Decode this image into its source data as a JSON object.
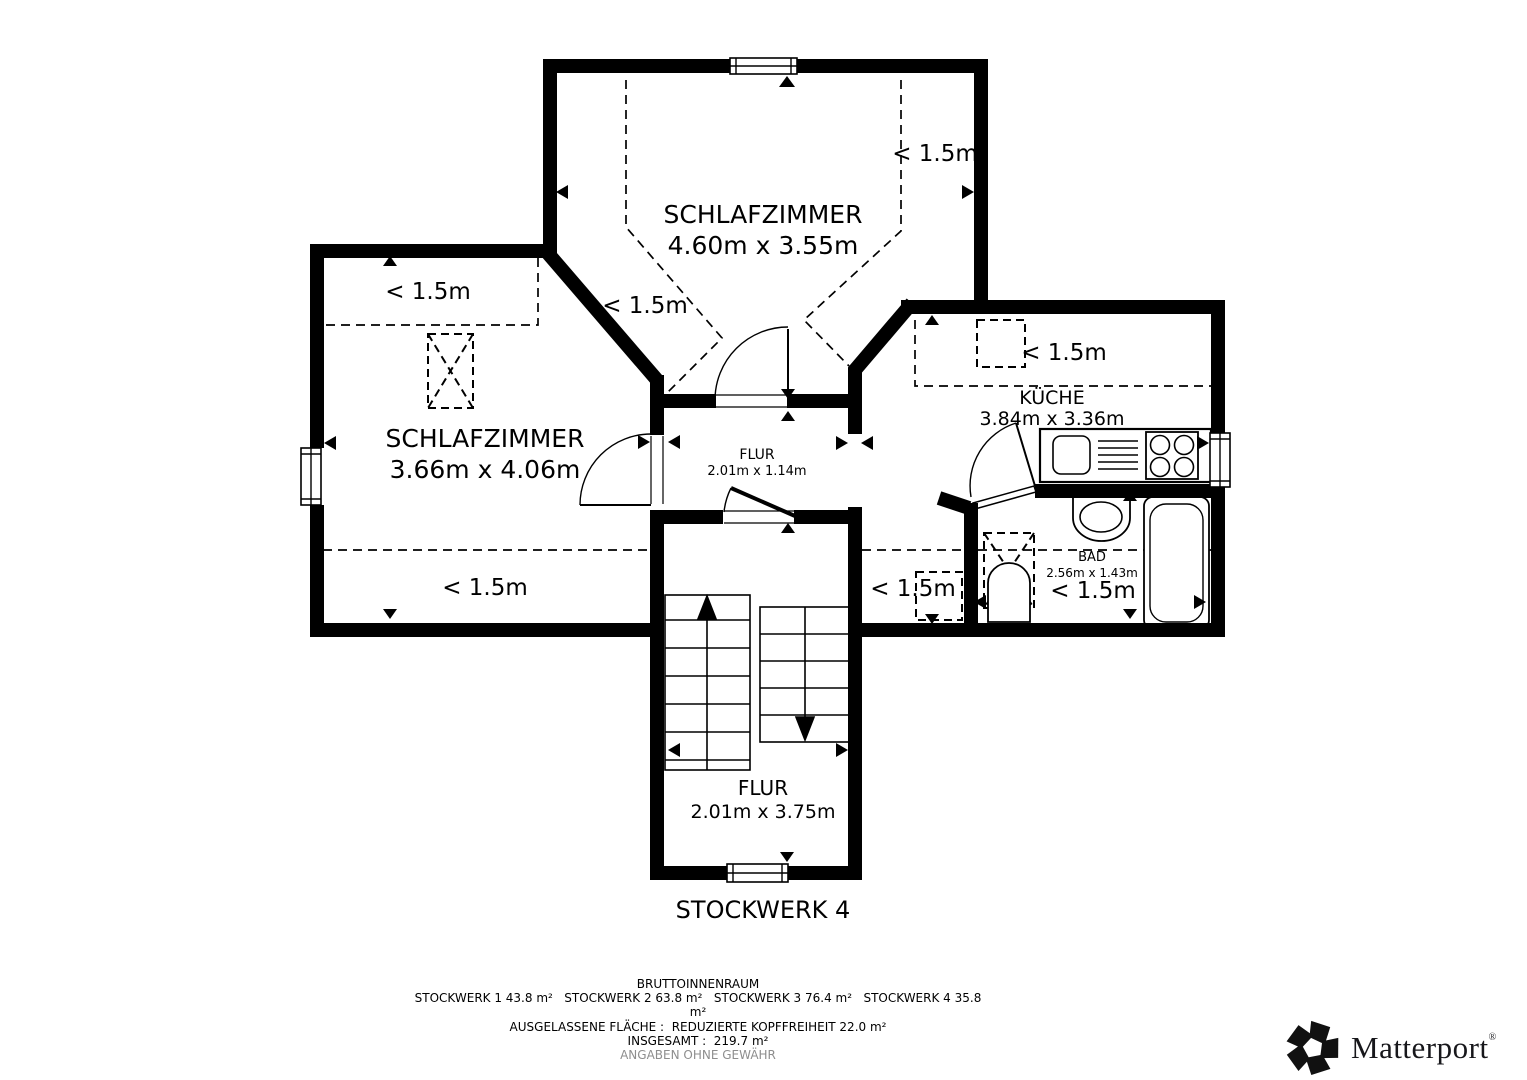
{
  "plan": {
    "title": "STOCKWERK 4",
    "headroom_label": "< 1.5m",
    "rooms": {
      "bedroom_top": {
        "name": "SCHLAFZIMMER",
        "dims": "4.60m x 3.55m"
      },
      "bedroom_left": {
        "name": "SCHLAFZIMMER",
        "dims": "3.66m x 4.06m"
      },
      "kitchen": {
        "name": "KÜCHE",
        "dims": "3.84m x 3.36m"
      },
      "bath": {
        "name": "BAD",
        "dims": "2.56m x 1.43m",
        "headroom": "< 1.5m"
      },
      "hall_upper": {
        "name": "FLUR",
        "dims": "2.01m x 1.14m"
      },
      "hall_lower": {
        "name": "FLUR",
        "dims": "2.01m x 3.75m"
      }
    }
  },
  "footer": {
    "heading": "BRUTTOINNENRAUM",
    "floors_line": "STOCKWERK 1 43.8 m²   STOCKWERK 2 63.8 m²   STOCKWERK 3 76.4 m²   STOCKWERK 4 35.8",
    "floors_wrap": "m²",
    "excluded_line": "AUSGELASSENE FLÄCHE :  REDUZIERTE KOPFFREIHEIT 22.0 m²",
    "total_line": "INSGESAMT :  219.7 m²",
    "disclaimer": "ANGABEN OHNE GEWÄHR"
  },
  "logo": {
    "name": "Matterport",
    "registered": "®"
  },
  "colors": {
    "wall": "#000000",
    "text": "#000000",
    "disclaimer": "#8e8e8e"
  }
}
